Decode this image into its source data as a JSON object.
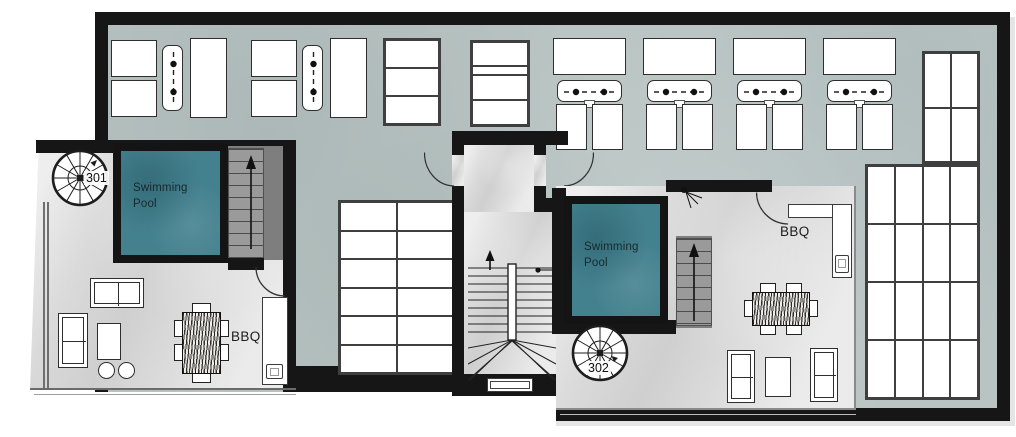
{
  "plan": {
    "units": [
      {
        "id": "301",
        "pool_label": "Swimming Pool",
        "bbq_label": "BBQ"
      },
      {
        "id": "302",
        "pool_label": "Swimming Pool",
        "bbq_label": "BBQ"
      }
    ],
    "colors": {
      "pool": "#44818f",
      "deck_concrete": "#b8c3c2",
      "terrace_marble": "#dadada",
      "wall": "#161616",
      "stair": "#9a9a9a",
      "furniture_outline": "#2e2e2e"
    }
  }
}
